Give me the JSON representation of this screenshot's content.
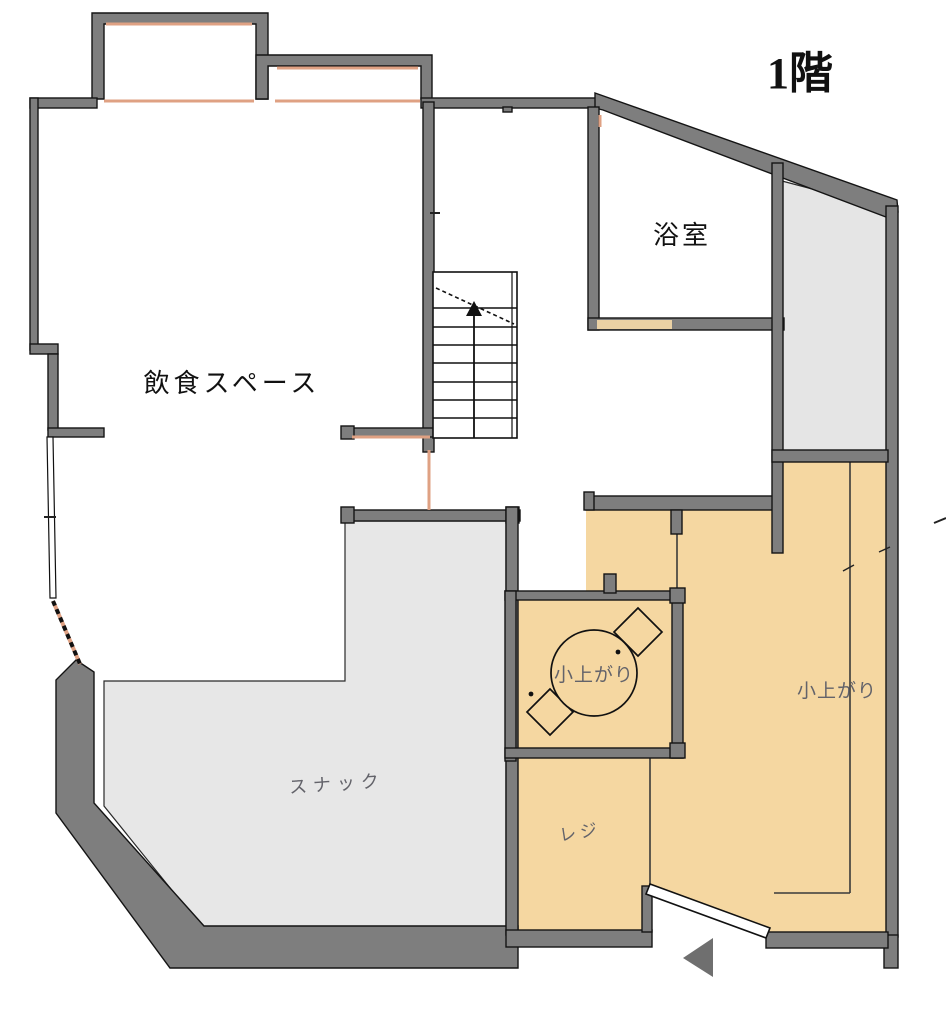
{
  "floor_plan": {
    "title": "1階",
    "rooms": {
      "dining": {
        "label": "飲食スペース"
      },
      "bathroom": {
        "label": "浴室"
      },
      "snack": {
        "label": "スナック"
      },
      "koagari_center": {
        "label": "小上がり"
      },
      "koagari_right": {
        "label": "小上がり"
      },
      "register": {
        "label": "レジ"
      }
    },
    "features": {
      "stairs": "staircase-with-up-arrow",
      "table": "round-table-with-two-cushions",
      "entrance": "entrance-arrow"
    },
    "colors": {
      "wall_gray": "#7e7e7e",
      "tatami_tan": "#f5d7a1",
      "room_light_gray": "#e7e7e7",
      "window_accent_salmon": "#dfa183",
      "bath_door_tan": "#ead1a4",
      "label_gray": "#63636a",
      "label_black": "#111111"
    }
  }
}
